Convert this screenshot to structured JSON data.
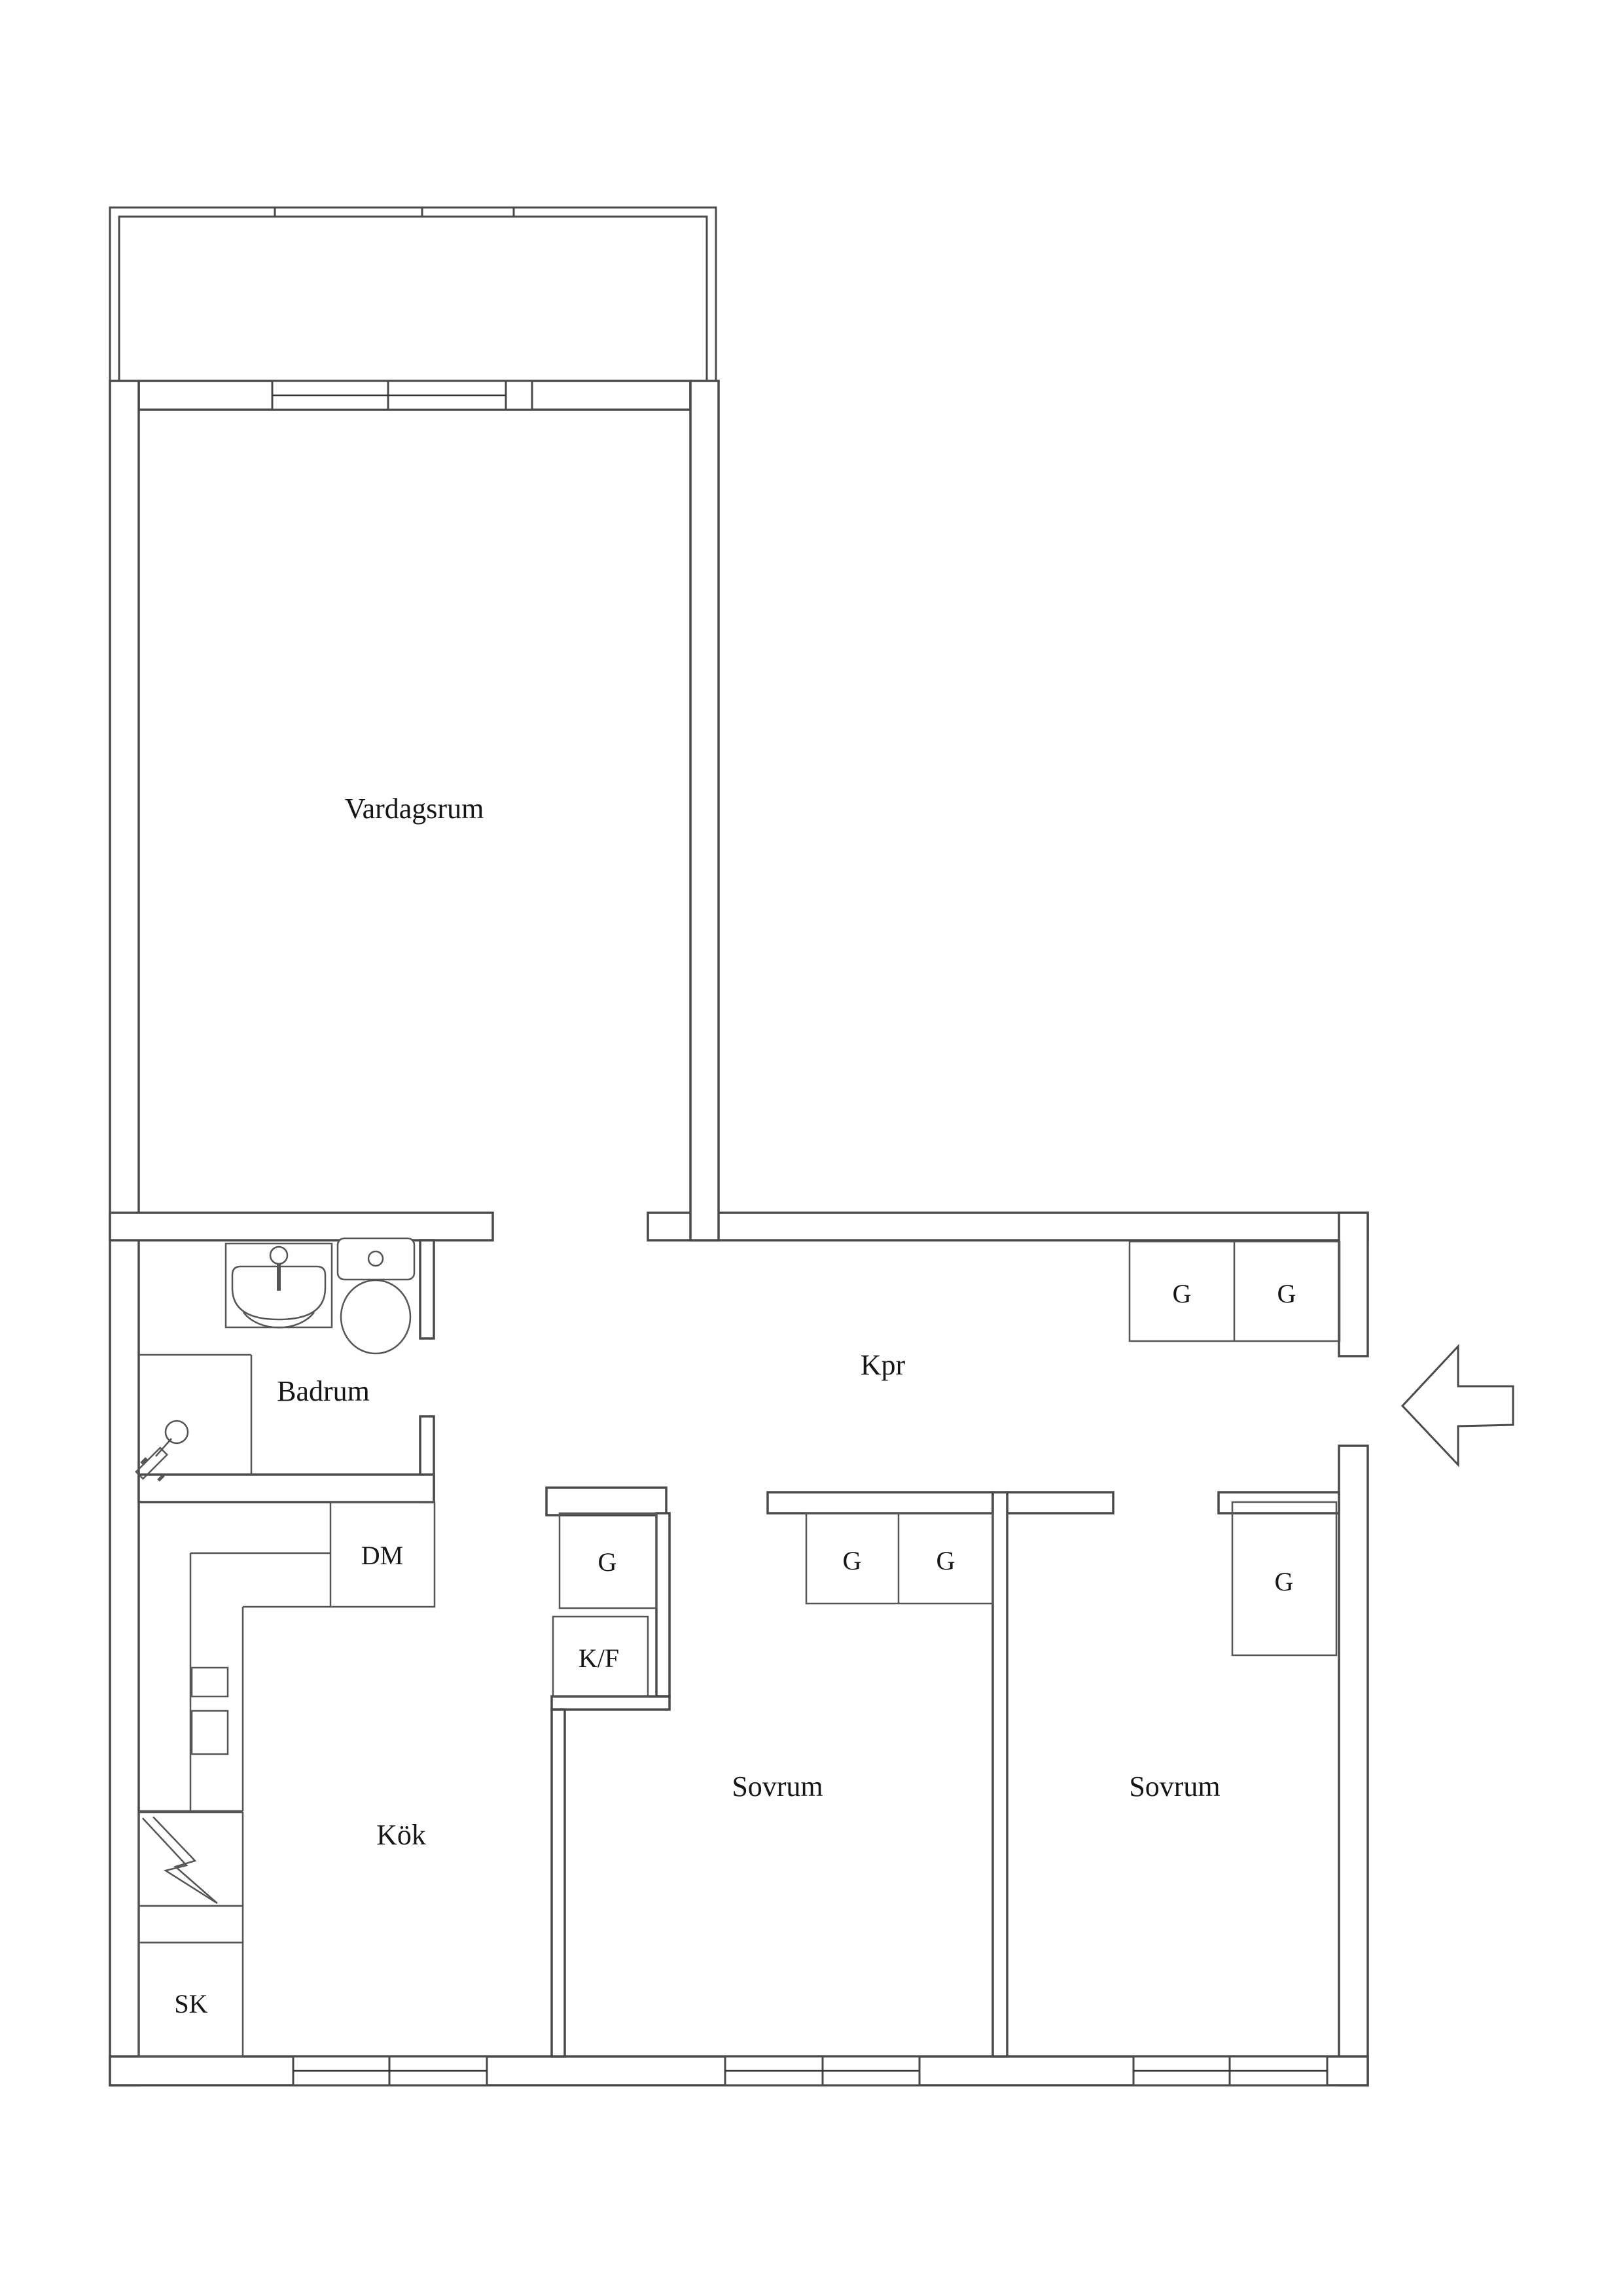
{
  "floor_plan": {
    "rooms": {
      "living_room": {
        "label": "Vardagsrum"
      },
      "bathroom": {
        "label": "Badrum"
      },
      "hallway": {
        "label": "Kpr"
      },
      "kitchen": {
        "label": "Kök"
      },
      "bedroom_1": {
        "label": "Sovrum"
      },
      "bedroom_2": {
        "label": "Sovrum"
      }
    },
    "fixtures": {
      "dishwasher": {
        "label": "DM"
      },
      "fridge_freezer": {
        "label": "K/F"
      },
      "cleaning_closet": {
        "label": "SK"
      },
      "wardrobe_hall_left": {
        "label": "G"
      },
      "wardrobe_hall_right": {
        "label": "G"
      },
      "wardrobe_kitchen": {
        "label": "G"
      },
      "wardrobe_bedroom1_left": {
        "label": "G"
      },
      "wardrobe_bedroom1_right": {
        "label": "G"
      },
      "wardrobe_bedroom2": {
        "label": "G"
      }
    },
    "colors": {
      "wall_line": "#4a4a4a",
      "fixture_line": "#555555",
      "text": "#161616",
      "background": "#ffffff"
    }
  }
}
